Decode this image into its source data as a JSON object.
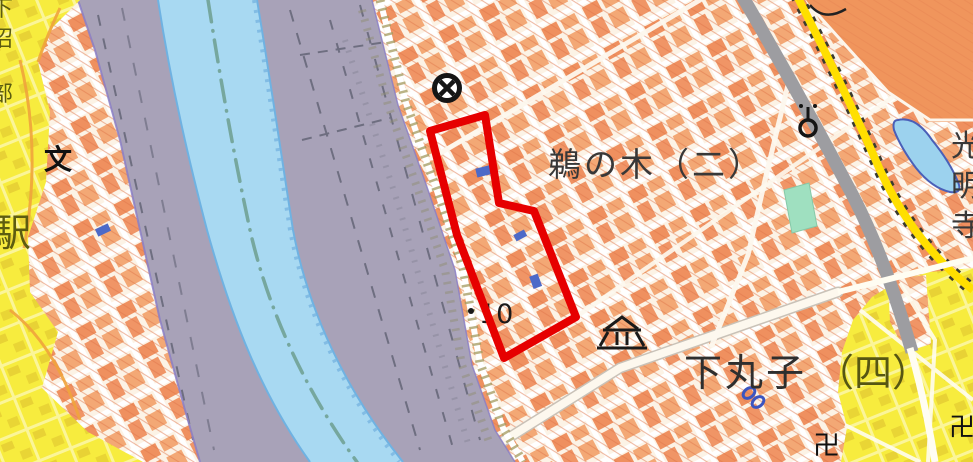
{
  "map": {
    "description": "Japanese GSI-style topographic map, Tama River area, with red highlighted parcel",
    "region_labels": {
      "unoki": "鵜の木（二）",
      "shimomaruko": "下丸子",
      "shimomaruko_suffix": "（四）",
      "spot_elevation": "10"
    },
    "edge_labels": {
      "left_vertical_chars": [
        "下",
        "沼",
        "部"
      ],
      "station": "駅",
      "right_vertical_chars": [
        "光",
        "明",
        "寺"
      ]
    },
    "symbol_glyphs": {
      "school": "文",
      "temple_a": "卍",
      "temple_b": "卍"
    },
    "symbols_legend": {
      "police-station-icon": "circle with X (koban/police)",
      "museum-icon": "building facade (museum)",
      "monument-icon": "circle with stem (monument)",
      "water-gate-icon": "blue chain link (water feature)",
      "spot-elevation-dot": "black dot elevation point"
    },
    "colors": {
      "river_blue": "#a8d9f2",
      "riverbank_purple": "#a8a2b8",
      "urban_base_cream": "#fcf3e6",
      "urban_hatch_orange": "#e0764a",
      "building_orange": "#ee8550",
      "yellow_zone": "#f7ec3e",
      "yellow_building": "#d9bd2a",
      "park_green": "#9fe0c0",
      "pond_blue": "#9cd2ee",
      "highlight_red": "#e60000",
      "road_gray": "#9d9da1",
      "road_yellow": "#ffdf00",
      "label_dark": "#2e2e2e",
      "label_olive": "#5c5c10",
      "boundary_teal": "#76a79e"
    }
  }
}
